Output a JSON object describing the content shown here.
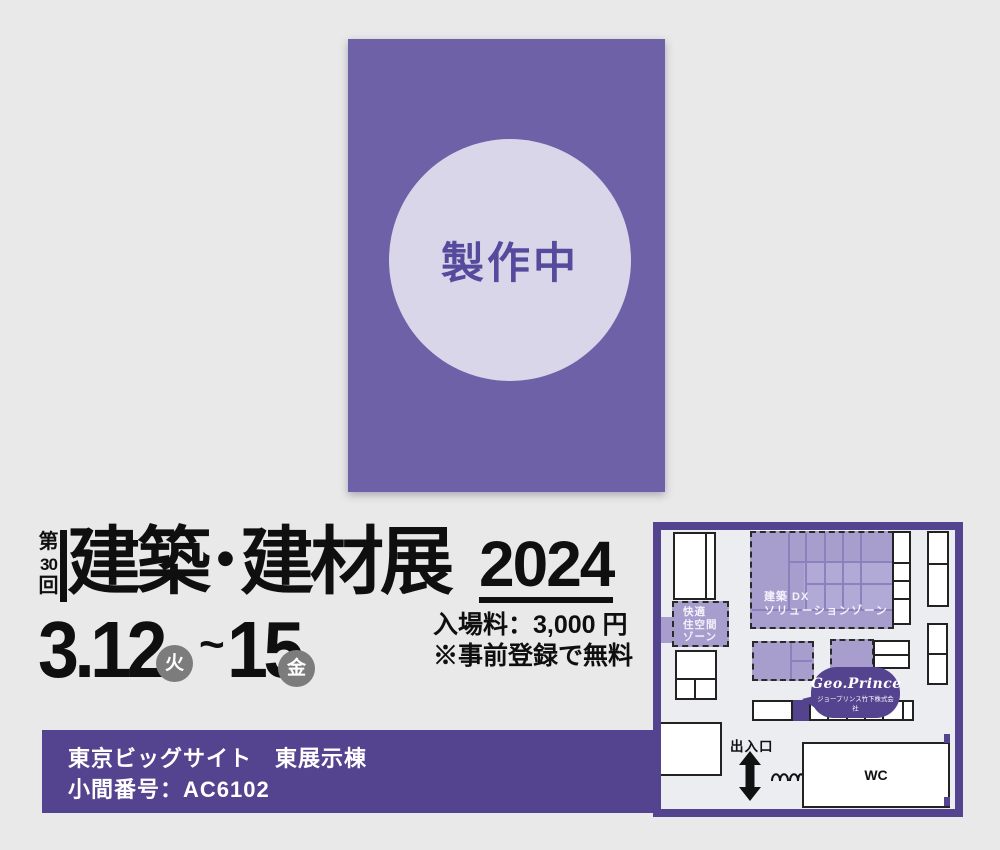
{
  "poster": {
    "status": "製作中"
  },
  "title": {
    "edition": {
      "prefix": "第",
      "number": "30",
      "suffix": "回"
    },
    "name": "建築･建材展",
    "year": "2024"
  },
  "schedule": {
    "start_date": "3.12",
    "start_day": "火",
    "separator": "~",
    "end_date": "15",
    "end_day": "金"
  },
  "admission": {
    "fee": "入場料：3,000 円",
    "note": "※事前登録で無料"
  },
  "venue": {
    "place": "東京ビッグサイト　東展示棟",
    "booth": "小間番号：AC6102"
  },
  "map": {
    "zone_comfort": {
      "line1": "快適",
      "line2": "住空間",
      "line3": "ゾーン"
    },
    "zone_dx": {
      "line1": "建築 DX",
      "line2": "ソリューションゾーン"
    },
    "exhibitor": {
      "logo": "Geo.Prince",
      "company": "ジョープリンス竹下株式会社"
    },
    "entrance": "出入口",
    "wc": "WC"
  },
  "colors": {
    "deep_purple": "#54438f",
    "poster_purple": "#6e61a7",
    "circle_lavender": "#d9d6e9",
    "zone_purple": "#a79ecd",
    "badge_gray": "#7d7c7c",
    "background": "#e9e9e9"
  }
}
